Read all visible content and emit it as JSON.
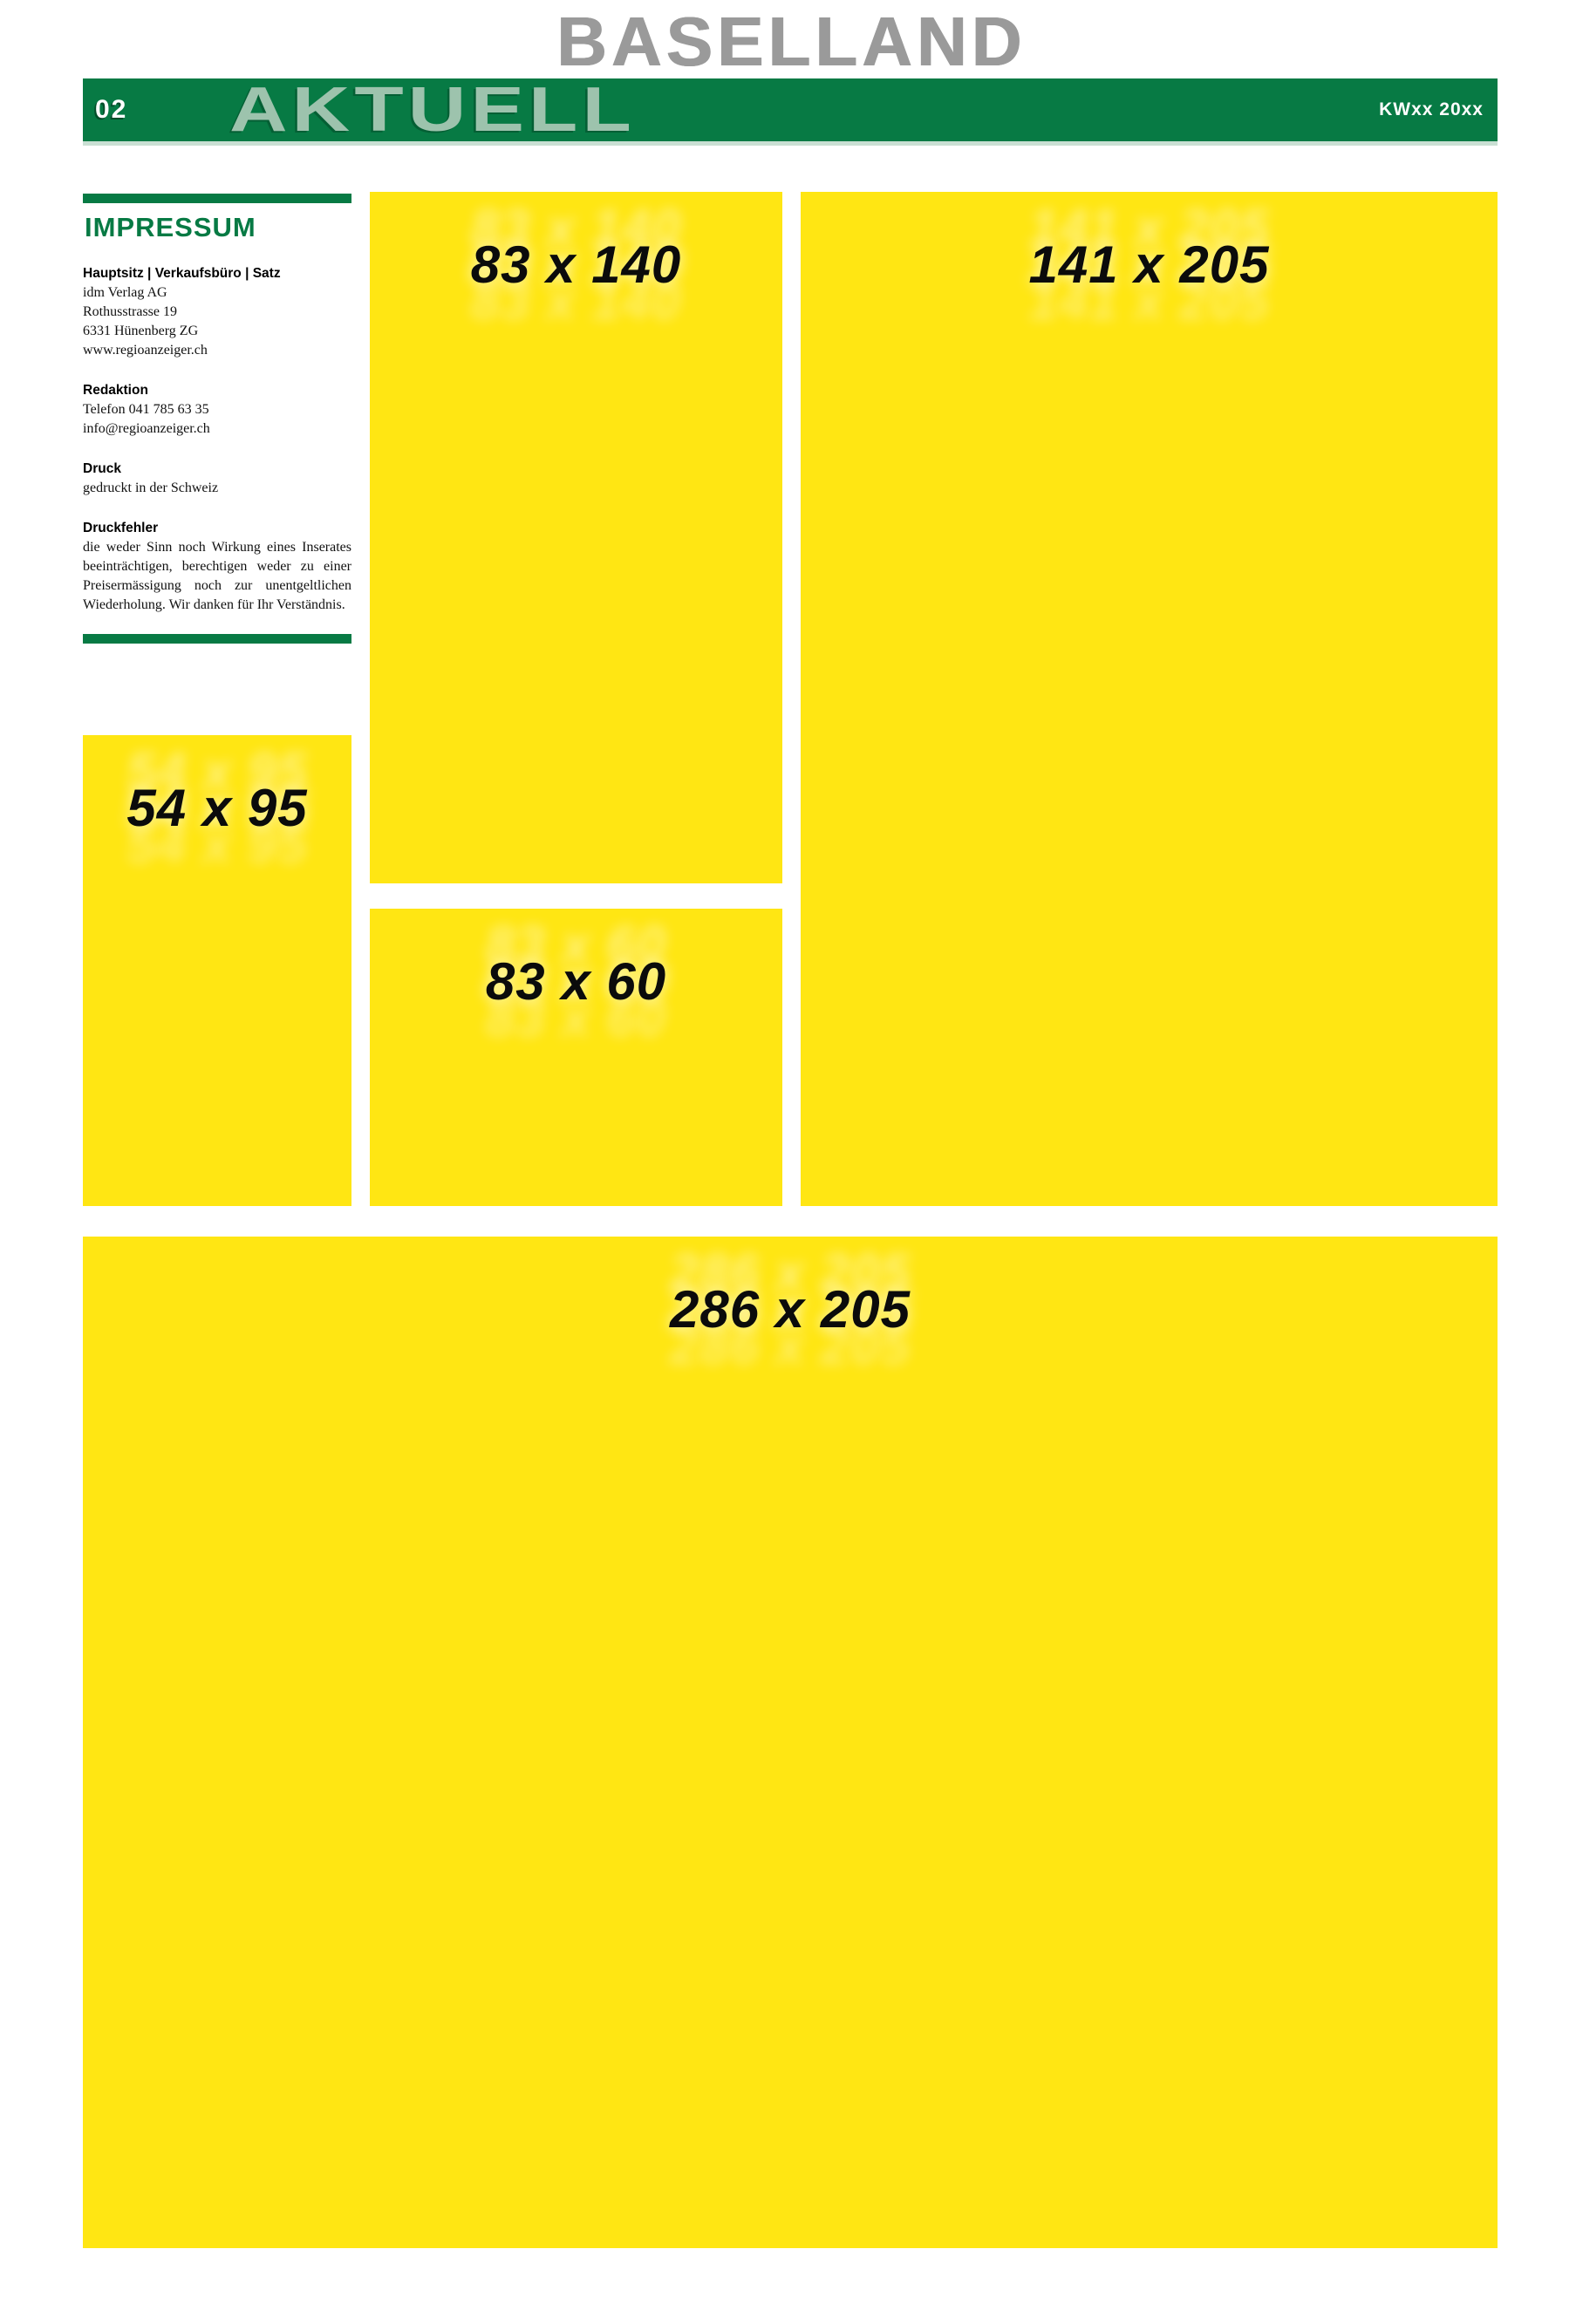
{
  "masthead": {
    "region_title": "BASELLAND"
  },
  "topbar": {
    "page_number": "02",
    "section_title": "AKTUELL",
    "issue_stamp": "KWxx 20xx"
  },
  "impressum": {
    "title": "IMPRESSUM",
    "blocks": [
      {
        "header": "Hauptsitz | Verkaufsbüro | Satz",
        "lines": [
          "idm Verlag AG",
          "Rothusstrasse 19",
          "6331 Hünenberg ZG",
          "www.regioanzeiger.ch"
        ]
      },
      {
        "header": "Redaktion",
        "lines": [
          "Telefon 041 785 63 35",
          "info@regioanzeiger.ch"
        ]
      },
      {
        "header": "Druck",
        "lines": [
          "gedruckt in der Schweiz"
        ]
      },
      {
        "header": "Druckfehler",
        "paragraph": "die weder Sinn noch Wirkung eines Inserates beeinträchtigen, berechtigen weder zu einer Preisermässigung noch zur unentgeltlichen Wiederholung. Wir danken für Ihr Verständnis."
      }
    ]
  },
  "ads": [
    {
      "label": "83 x 140"
    },
    {
      "label": "141 x 205"
    },
    {
      "label": "54 x 95"
    },
    {
      "label": "83 x 60"
    },
    {
      "label": "286 x 205"
    }
  ],
  "colors": {
    "green": "#077a44",
    "light_green": "#9dc3ad",
    "pale_green": "#c9dfd3",
    "yellow": "#ffe613",
    "gray": "#9a9a9a",
    "ink": "#111111"
  }
}
